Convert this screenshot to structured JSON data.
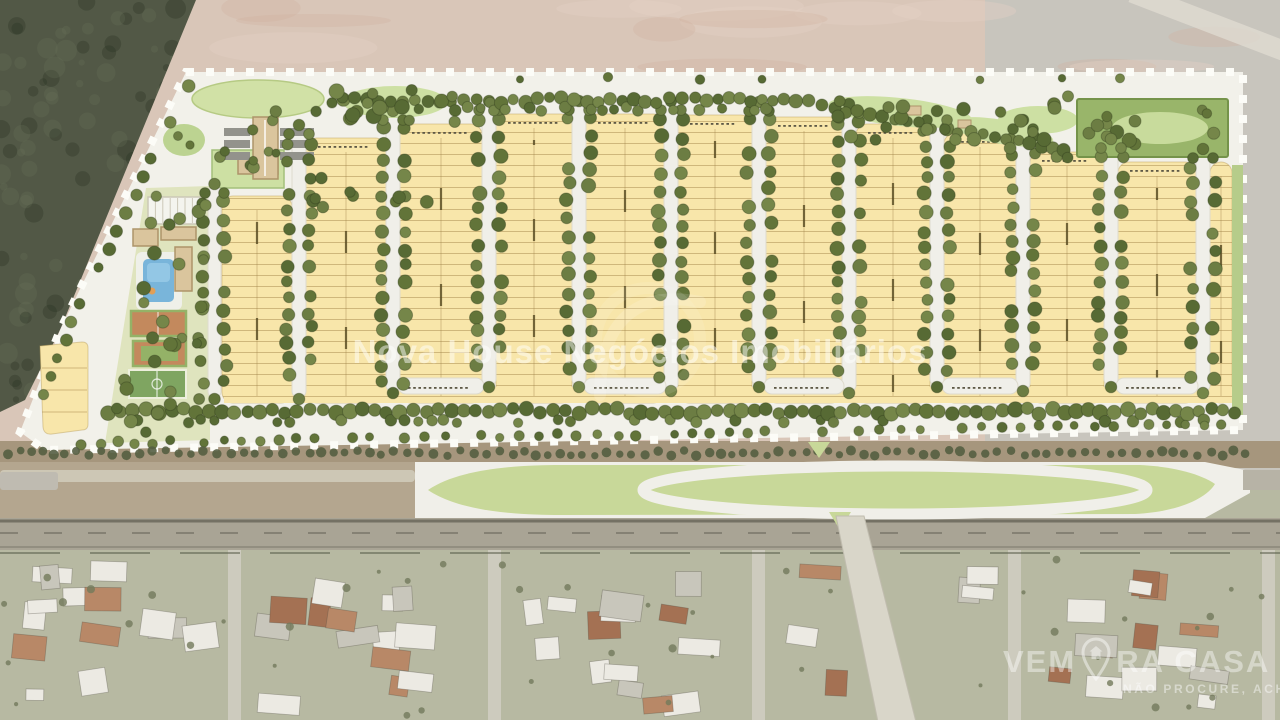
{
  "watermark": {
    "text": "Nova House Negócios Imobiliários"
  },
  "brand_logo": {
    "prefix": "VEM",
    "suffix": "RA CASA",
    "tagline": "NÃO PROCURE, ACHE",
    "icon": "map-pin-house-icon"
  },
  "palette": {
    "forest": "#49503d",
    "forest_dark": "rgba(25,35,20,0.30)",
    "forest_light": "rgba(105,115,85,0.22)",
    "soil_pink": "#d7c3b5",
    "soil_gray": "#c6c2ba",
    "scrub": "#a29176",
    "plan_ground": "#f2f1e9",
    "boundary_dash": "#fcfcf7",
    "block_yellow": "#f8e5a6",
    "lot_line": "rgba(170,140,75,0.55)",
    "center_dash": "#4e4116",
    "tree_greens": [
      "#5a6d2f",
      "#657739",
      "#4f632a",
      "#6e8040"
    ],
    "shrub_dark": "#4d5638",
    "amenity_ground": "#dee3bb",
    "lawn": "#cfe0a2",
    "garden": "#cbdf9f",
    "park_green": "#94b162",
    "park_border": "#6e8e41",
    "building_tan": "#d9c298",
    "building_edge": "#a98f62",
    "pool_blue": "#72b1d8",
    "pool_light": "#8ec4e4",
    "court_clay": "#c08355",
    "court_green": "#8fae5f",
    "field_green": "#79a159",
    "median_green": "#c6d694",
    "road_white": "#f0efe8",
    "road_tan": "#b0a28a",
    "highway_gray": "#a5a090",
    "highway_line": "#6d6a5c",
    "hood_ground": "#b4b69e",
    "street_gray": "#cbc9bb",
    "roof_white": "#ebe9e2",
    "roof_terracotta": "#b5825f",
    "roof_terracotta_dark": "#a06a4a",
    "roof_gray": "#c6c3b8",
    "lane_stripe": "#8e8e86",
    "green_strip": "#b3ca84"
  }
}
